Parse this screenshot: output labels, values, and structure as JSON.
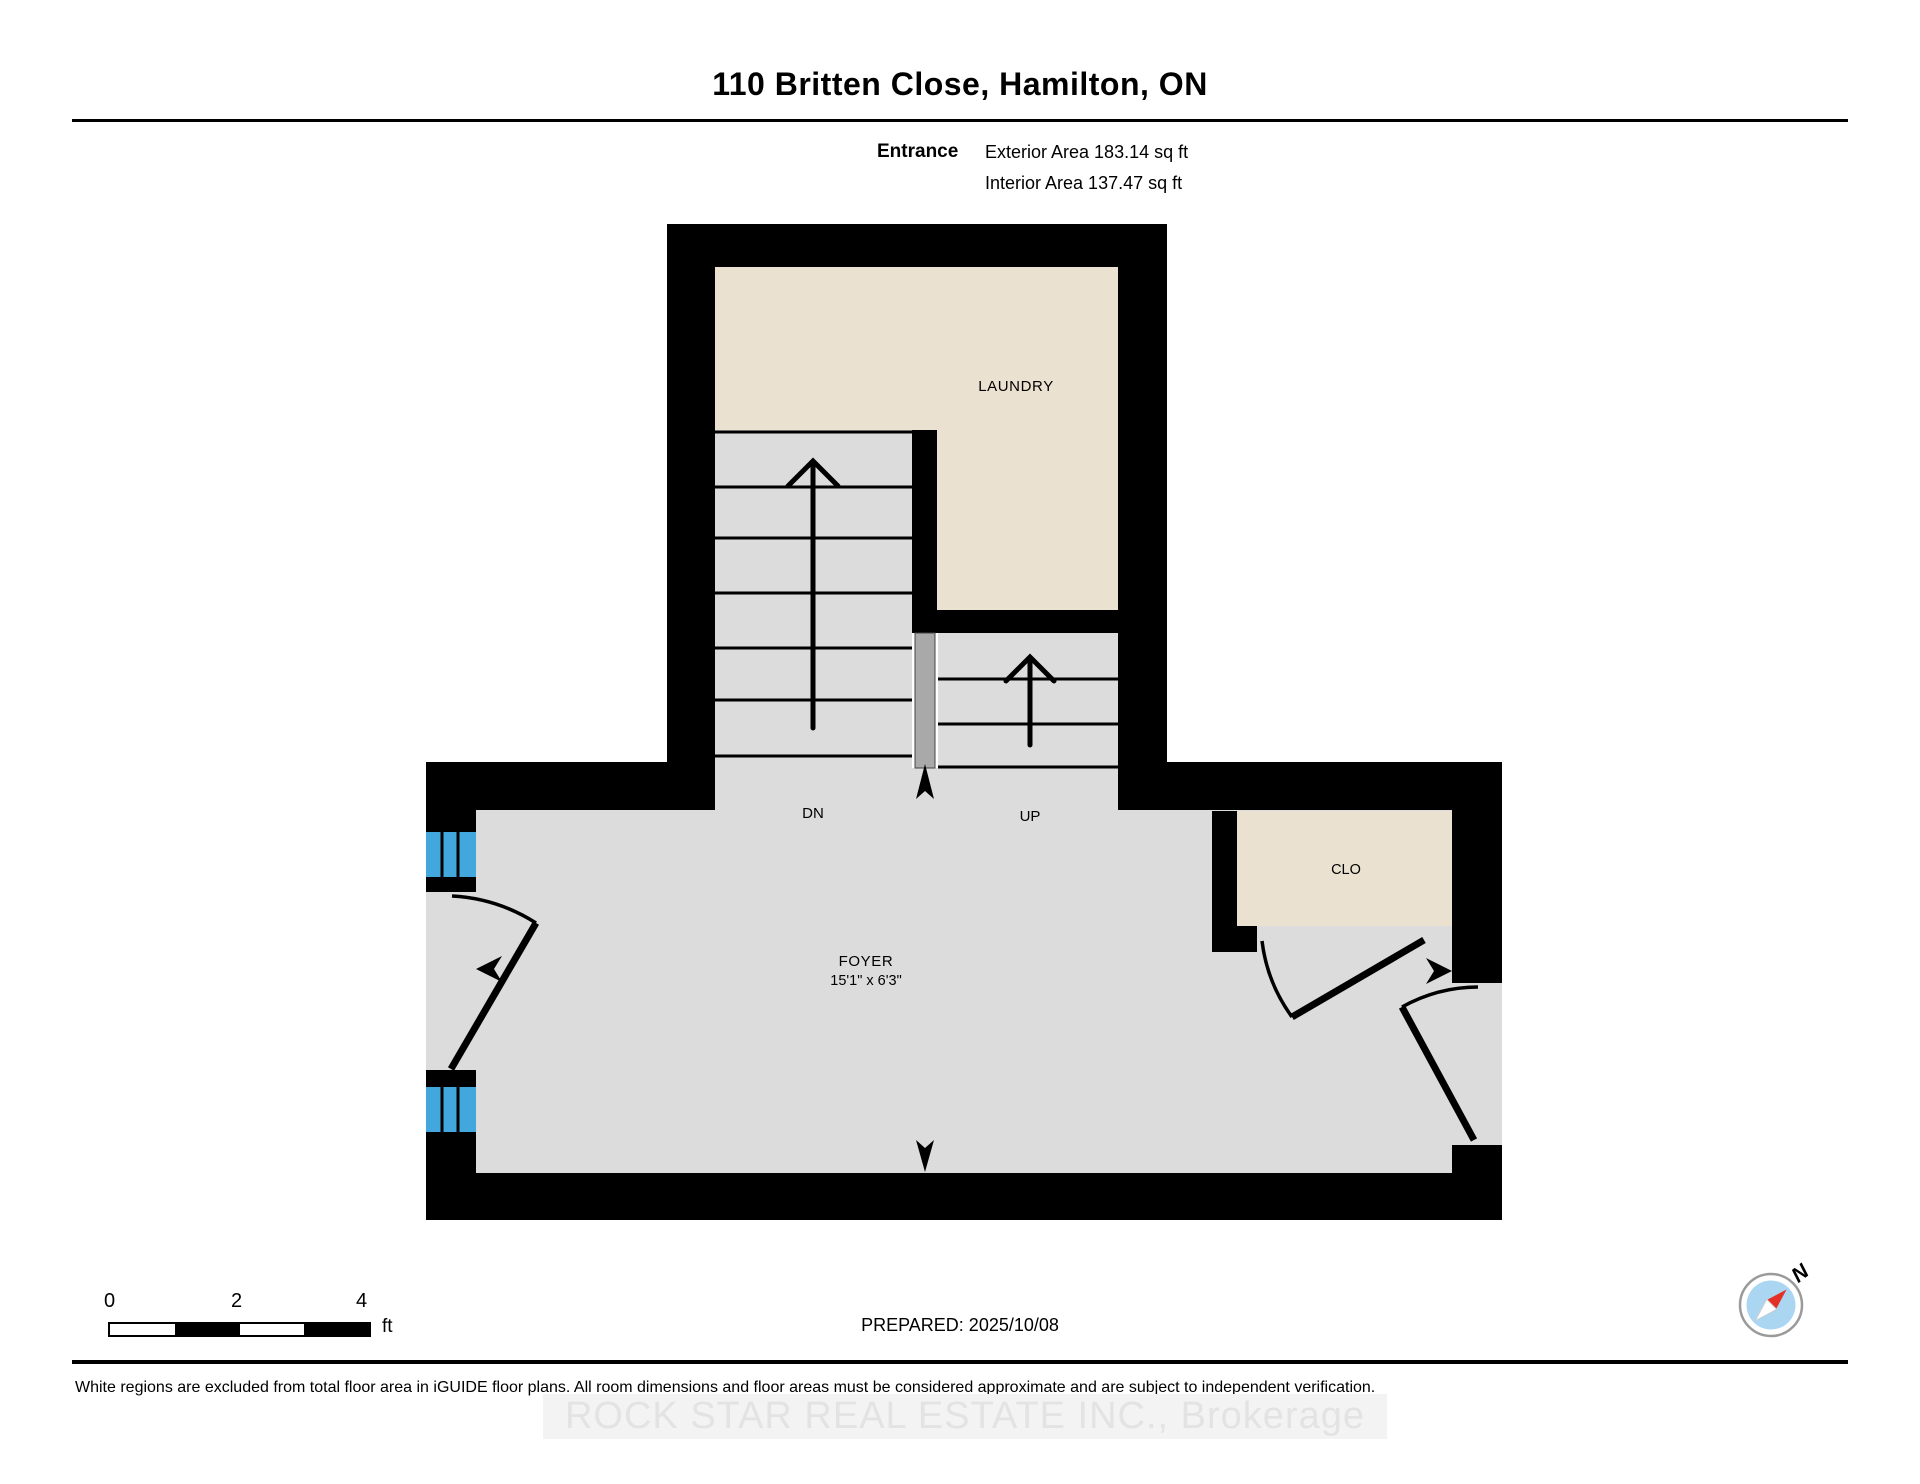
{
  "header": {
    "title": "110 Britten Close, Hamilton, ON",
    "floor_label": "Entrance",
    "exterior_area": "Exterior Area 183.14 sq ft",
    "interior_area": "Interior Area 137.47 sq ft"
  },
  "plan": {
    "labels": {
      "laundry": "LAUNDRY",
      "dn": "DN",
      "up": "UP",
      "foyer": "FOYER",
      "foyer_dims": "15'1\" x 6'3\"",
      "closet": "CLO"
    }
  },
  "footer": {
    "scale": {
      "ticks": [
        "0",
        "2",
        "4"
      ],
      "unit": "ft"
    },
    "prepared": "PREPARED: 2025/10/08",
    "compass_label": "N",
    "disclaimer": "White regions are excluded from total floor area in iGUIDE floor plans. All room dimensions and floor areas must be considered approximate and are subject to independent verification.",
    "watermark": "ROCK STAR REAL ESTATE INC., Brokerage"
  },
  "colors": {
    "wall": "#000000",
    "floor_gray": "#dcdcdc",
    "room_beige": "#eae1d0",
    "railing_gray": "#a9a9a9",
    "window_blue": "#41a7dc",
    "compass_red": "#e53125",
    "compass_inner_blue": "#abd6f2"
  }
}
